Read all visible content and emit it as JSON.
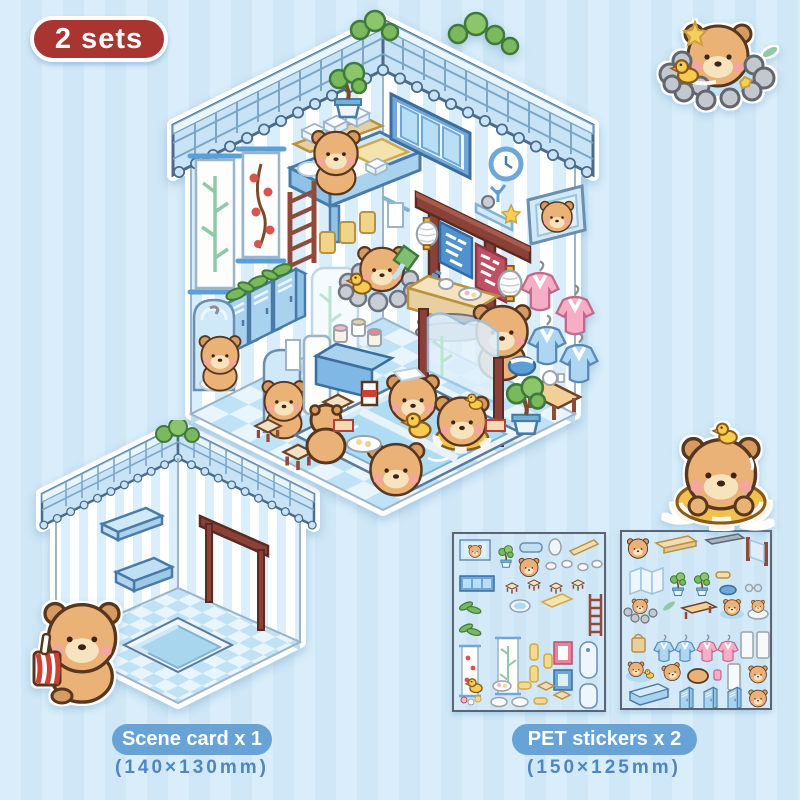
{
  "badge": {
    "label": "2 sets"
  },
  "scene_card_label": {
    "label": "Scene card x 1",
    "dimensions": "(140×130mm)"
  },
  "pet_stickers_label": {
    "label": "PET stickers x 2",
    "dimensions": "(150×125mm)"
  },
  "main_scene": {
    "description": "Isometric capybara bathhouse room die-cut scene with striped walls, tiled roof, hot pool and bathing capybaras",
    "banner_left_char": "汤",
    "banner_right_char": "泉"
  },
  "stickers": {
    "hot_spring_capybara": "Capybara soaking in a stone hot spring with a rubber duck",
    "swim_ring_capybara": "Capybara floating in a striped swim ring with a duckling on its head",
    "drink_capybara": "Capybara holding a red striped drink cup"
  },
  "sheets": {
    "sheet1_description": "PET sticker sheet 1: furniture, scrolls, window, ladder, stools and props",
    "sheet2_description": "PET sticker sheet 2: capybaras, robes, mirrors, lockers and benches"
  },
  "colors": {
    "accent_red": "#a93530",
    "label_blue": "#68a3d8",
    "text_blue": "#4e86c0",
    "background_light": "#d9eefa",
    "background_dark": "#cfe7f6",
    "roof_blue": "#c8e3f5",
    "water_blue": "#aedcf4"
  }
}
